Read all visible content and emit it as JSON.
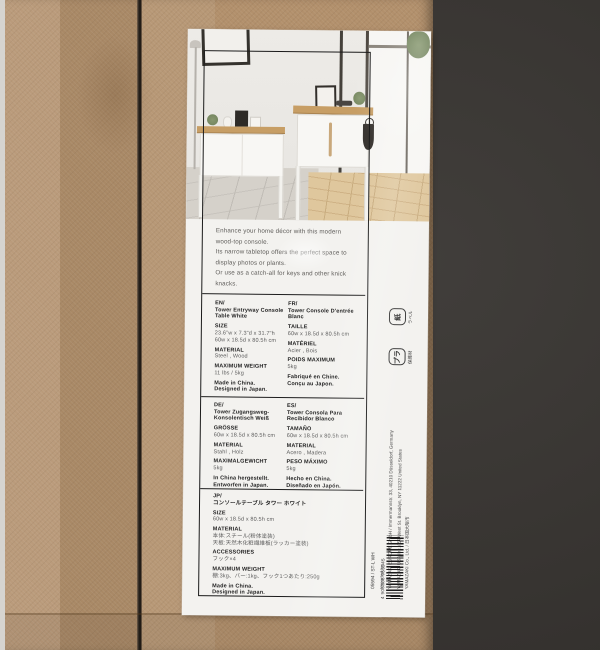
{
  "colors": {
    "background": "#34312e",
    "cardboard": "#b2906c",
    "label": "#f3f2ef",
    "inner_frame": "#1b1b1b",
    "wood_top": "#c79e65",
    "text_dark": "#1f1f1f",
    "text_gray": "#5c5c5c"
  },
  "label": {
    "description_lines": [
      "Enhance your home décor with this modern",
      "wood-top console.",
      "Its narrow tabletop offers the perfect space to",
      "display photos or plants.",
      "Or use as a catch-all for keys and other knick",
      "knacks."
    ],
    "columns": {
      "en": [
        {
          "b": 1,
          "s": "EN/"
        },
        {
          "b": 1,
          "s": "Tower Entryway Console"
        },
        {
          "b": 1,
          "s": "Table White"
        },
        {
          "b": 1,
          "g": 1,
          "s": "SIZE"
        },
        {
          "b": 0,
          "s": "23.6\"w x 7.3\"d x 31.7\"h"
        },
        {
          "b": 0,
          "s": "60w x 18.5d x 80.5h cm"
        },
        {
          "b": 1,
          "g": 1,
          "s": "MATERIAL"
        },
        {
          "b": 0,
          "s": "Steel , Wood"
        },
        {
          "b": 1,
          "g": 1,
          "s": "MAXIMUM WEIGHT"
        },
        {
          "b": 0,
          "s": "11 lbs / 5kg"
        },
        {
          "b": 1,
          "g": 1,
          "s": "Made in China."
        },
        {
          "b": 1,
          "s": "Designed in Japan."
        }
      ],
      "fr": [
        {
          "b": 1,
          "s": "FR/"
        },
        {
          "b": 1,
          "s": "Tower Console D'entrée"
        },
        {
          "b": 1,
          "s": "Blanc"
        },
        {
          "b": 1,
          "g": 1,
          "s": "TAILLE"
        },
        {
          "b": 0,
          "s": "60w x 18.5d x 80.5h cm"
        },
        {
          "b": 1,
          "g": 1,
          "s": "MATÉRIEL"
        },
        {
          "b": 0,
          "s": "Acier , Bois"
        },
        {
          "b": 1,
          "g": 1,
          "s": "POIDS MAXIMUM"
        },
        {
          "b": 0,
          "s": "5kg"
        },
        {
          "b": 1,
          "g": 1,
          "s": "Fabriqué en Chine."
        },
        {
          "b": 1,
          "s": "Conçu au Japon."
        }
      ],
      "de": [
        {
          "b": 1,
          "s": "DE/"
        },
        {
          "b": 1,
          "s": "Tower Zugangsweg-"
        },
        {
          "b": 1,
          "s": "Konsolentisch Weiß"
        },
        {
          "b": 1,
          "g": 1,
          "s": "GRÖSSE"
        },
        {
          "b": 0,
          "s": "60w x 18.5d x 80.5h cm"
        },
        {
          "b": 1,
          "g": 1,
          "s": "MATERIAL"
        },
        {
          "b": 0,
          "s": "Stahl , Holz"
        },
        {
          "b": 1,
          "g": 1,
          "s": "MAXIMALGEWICHT"
        },
        {
          "b": 0,
          "s": "5kg"
        },
        {
          "b": 1,
          "g": 1,
          "s": "In China hergestellt."
        },
        {
          "b": 1,
          "s": "Entworfen in Japan."
        }
      ],
      "es": [
        {
          "b": 1,
          "s": "ES/"
        },
        {
          "b": 1,
          "s": "Tower Consola Para"
        },
        {
          "b": 1,
          "s": "Recibidor Blanco"
        },
        {
          "b": 1,
          "g": 1,
          "s": "TAMAÑO"
        },
        {
          "b": 0,
          "s": "60w x 18.5d x 80.5h cm"
        },
        {
          "b": 1,
          "g": 1,
          "s": "MATERIAL"
        },
        {
          "b": 0,
          "s": "Acero , Madera"
        },
        {
          "b": 1,
          "g": 1,
          "s": "PESO MÁXIMO"
        },
        {
          "b": 0,
          "s": "5kg"
        },
        {
          "b": 1,
          "g": 1,
          "s": "Hecho en China."
        },
        {
          "b": 1,
          "s": "Diseñado en Japón."
        }
      ],
      "jp": [
        {
          "b": 1,
          "s": "JP/"
        },
        {
          "b": 1,
          "s": "コンソールテーブル タワー ホワイト"
        },
        {
          "b": 1,
          "g": 1,
          "s": "SIZE"
        },
        {
          "b": 0,
          "s": "60w x 18.5d x 80.5h cm"
        },
        {
          "b": 1,
          "g": 1,
          "s": "MATERIAL"
        },
        {
          "b": 0,
          "s": "本体:スチール(粉体塗装)"
        },
        {
          "b": 0,
          "s": "天板:天然木化粧繊維板(ラッカー塗装)"
        },
        {
          "b": 1,
          "g": 1,
          "s": "ACCESSORIES"
        },
        {
          "b": 0,
          "s": "フック×4"
        },
        {
          "b": 1,
          "g": 1,
          "s": "MAXIMUM WEIGHT"
        },
        {
          "b": 0,
          "s": "棚:3kg、バー:1kg、フック1つあたり:250g"
        },
        {
          "b": 1,
          "g": 1,
          "s": "Made in China."
        },
        {
          "b": 1,
          "s": "Designed in Japan."
        }
      ]
    }
  },
  "right_column": {
    "recycle_marks": [
      {
        "glyph": "紙",
        "caption": "ラベル"
      },
      {
        "glyph": "プラ",
        "caption": "保護材"
      }
    ],
    "company_lines": [
      "05594 / ST-L WH",
      "Imported by:",
      "YAMAZAKI EUROPE GmbH / Immermannstr. 33, 40210 Düsseldorf, Germany",
      "YAMAZAKI USA Inc. / 57 West St. Brooklyn, NY 11222 United States",
      "YAMAZAKI Co., Ltd. / 日本国大阪市"
    ],
    "barcode_number": "4 903208 055945"
  }
}
